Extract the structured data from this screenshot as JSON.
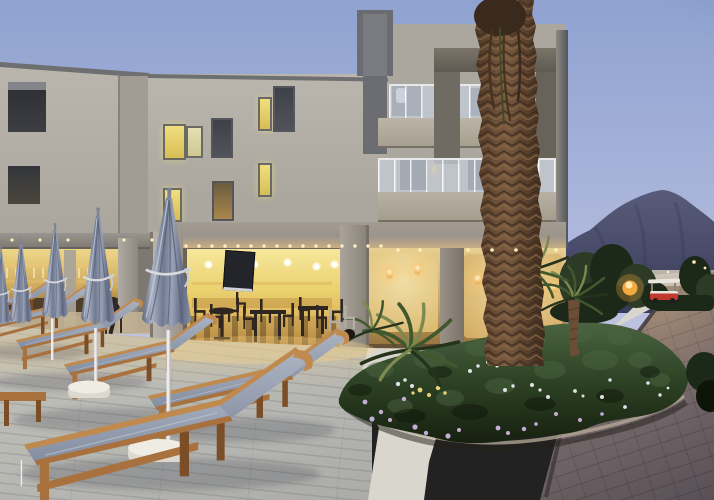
{
  "scene": {
    "description": "Modern three-storey hotel exterior photographed at dusk: beige walls with dark concrete frames, glass balcony railings, warmly lit restaurant and lobby on the ground floor, pool terrace with closed grey umbrellas and wooden sun loungers, flower bed with small palms, a tall palm trunk, stone driveway with a golf cart, and a mountain under a periwinkle evening sky",
    "time_of_day": "dusk",
    "setting": "hotel-resort-exterior",
    "counts": {
      "closed_umbrellas": 6,
      "sun_loungers": 6,
      "building_storeys": 3,
      "small_palms": 3
    },
    "elements": [
      {
        "name": "dusk-sky",
        "description": "clear periwinkle evening sky"
      },
      {
        "name": "mountain",
        "description": "purple-blue mountain ridge behind the hotel, right side"
      },
      {
        "name": "hotel-left-wing",
        "description": "two-storey beige wing with two dark balcony niches"
      },
      {
        "name": "hotel-centre-block",
        "description": "beige facade with lit and dark windows over the restaurant"
      },
      {
        "name": "hotel-balcony-tower",
        "description": "three-storey block with grey concrete frames and glass balcony railings"
      },
      {
        "name": "restaurant-terrace",
        "description": "warm yellow lit open restaurant with dark tables and chairs and a wall TV"
      },
      {
        "name": "pool-bar",
        "description": "lit bar under a pergola on the far left with a seated guest"
      },
      {
        "name": "lobby",
        "description": "warm lit ground-floor wall with glowing sconces"
      },
      {
        "name": "closed-umbrellas",
        "description": "row of closed grey-blue parasols with white poles and round white bases"
      },
      {
        "name": "sun-loungers",
        "description": "teak-framed loungers with grey-blue mesh fabric on a light wooden deck"
      },
      {
        "name": "wooden-deck",
        "description": "pale grey plank decking of the pool terrace"
      },
      {
        "name": "white-garden-path",
        "description": "smooth light concrete path curving around the flower bed"
      },
      {
        "name": "flower-bed",
        "description": "dense green bed with purple, white and yellow flowers and uplit small palms"
      },
      {
        "name": "tall-palm-trunk",
        "description": "shaggy brown palm trunk rising through the full height of the frame"
      },
      {
        "name": "stone-driveway",
        "description": "mauve-grey stamped stone drive sloping up to the right"
      },
      {
        "name": "golf-cart",
        "description": "small red and white resort buggy parked on the driveway"
      },
      {
        "name": "globe-lamp",
        "description": "glowing amber garden globe light among the trees"
      },
      {
        "name": "trees",
        "description": "dark evergreen trees between garden and mountain"
      },
      {
        "name": "distant-lights",
        "description": "small warm street lights near the horizon"
      },
      {
        "name": "string-lights",
        "description": "rows of tiny warm downlights under the canopy and pergola"
      }
    ],
    "colors": {
      "sky_top": "#8fa2d0",
      "sky_mid": "#a9b4da",
      "sky_low": "#c2c6e2",
      "mountain_far": "#6a6e8a",
      "mtn_top": "#585c7a",
      "mtn_bottom": "#383b58",
      "wall_light": "#bab6ae",
      "wall_mid": "#aba79e",
      "wall_shade": "#a19d94",
      "frame_dark": "#64666c",
      "frame_warm": "#77736b",
      "parapet": "#6e6f71",
      "window_lit": "#e9d467",
      "window_pale": "#ddd6a0",
      "window_dark": "#44464e",
      "glass": "#c5cdd9",
      "glow_bright": "#f6e9a0",
      "glow_mid": "#ecd26f",
      "glow_deep": "#c89b4e",
      "canopy": "#9b948b",
      "canopy_lit": "#c9ae85",
      "deck": "#b6b7b2",
      "path_white": "#d8d6cd",
      "drive_light": "#9b8d8d",
      "drive_dark": "#5f565a",
      "garden_dark": "#16200f",
      "garden_mid": "#2f4526",
      "garden_light": "#4a6340",
      "flower_purple": "#c5aed6",
      "flower_white": "#ece7f0",
      "flower_yellow": "#e8d27a",
      "trunk_light": "#7a5a40",
      "trunk_dark": "#4e3826",
      "frond": "#41582f",
      "frond_lit": "#7d8a4f",
      "umbrella_light": "#aab1c2",
      "umbrella_mid": "#848da2",
      "umbrella_dark": "#5f6880",
      "wood_light": "#c08a4e",
      "wood_mid": "#a9713d",
      "wood_dark": "#7c4e28",
      "fabric_light": "#a3acbc",
      "fabric_mid": "#828ca0",
      "lamp": "#f2a93e",
      "silhouette": "#33281f",
      "cart_red": "#c03a2e",
      "cart_white": "#e9e6de",
      "white_base": "#efece4",
      "tree_dark": "#1c2818",
      "tree_mid": "#2c3a26"
    }
  }
}
